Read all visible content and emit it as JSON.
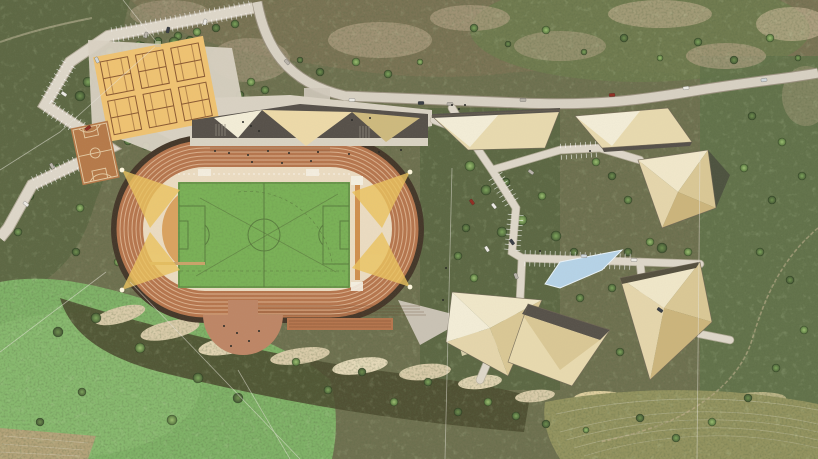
{
  "scene": {
    "title": "aerial masterplan rendering - hillside athletics park",
    "view": "top-down architectural site plan over aerial photo",
    "canvas": {
      "width": 818,
      "height": 459
    }
  },
  "palette": {
    "base": "#6f7150",
    "meadow": "#7fb267",
    "woodland": "#5c6743",
    "scrub": "#7b7354",
    "rock": "#d9cba9",
    "fieldOlive": "#93935f",
    "road": "#d7d0c2",
    "roadEdge": "#9a917f",
    "paving": "#d8d1c2",
    "stall": "#ffffff",
    "trackDark": "#45382a",
    "track": "#b5764e",
    "infield": "#eadbc1",
    "dzone": "#d79b55",
    "pitch": "#7ab157",
    "beam": "#eac35f",
    "tennis": "#eec272",
    "basketball": "#b57a4a",
    "roofCream": "#f2ecd6",
    "roofBeige": "#e7d9ae",
    "roofTan": "#cdb97e",
    "roofDark": "#57514a",
    "plaza": "#bd8666",
    "pool": "#b5d2e6",
    "person": "#2a2a26",
    "powerLine": "#e8e4da",
    "carColors": [
      "#eceae4",
      "#b9b4aa",
      "#8f2f23",
      "#3a3f46",
      "#cfd6da"
    ]
  },
  "features": {
    "stadium": {
      "name": "athletics stadium",
      "track_lanes": 8,
      "infield": "soccer pitch",
      "floodlight_beams": 4,
      "entrance_plaza": "semicircular south plaza"
    },
    "tennis_courts": {
      "count": 6,
      "rows": 2,
      "cols": 3
    },
    "basketball_court": {
      "count": 1
    },
    "grandstand": {
      "position": "north straight",
      "roof": "faceted triangles"
    },
    "buildings": {
      "count": 7,
      "style": "angular faceted stone roofs"
    },
    "pool": {
      "shape": "angular sliver"
    },
    "road": {
      "type": "mountain access road across north edge"
    },
    "parking": {
      "areas": [
        "northwest switchback lots",
        "cluster street parking"
      ]
    }
  },
  "parking": {
    "zigzag": [
      [
        253,
        8
      ],
      [
        108,
        36
      ],
      [
        70,
        62
      ],
      [
        45,
        105
      ],
      [
        110,
        148
      ],
      [
        32,
        185
      ],
      [
        8,
        228
      ]
    ],
    "tick_segments": [
      [
        253,
        8,
        108,
        36
      ],
      [
        70,
        62,
        45,
        105
      ],
      [
        45,
        105,
        110,
        148
      ],
      [
        110,
        148,
        32,
        185
      ],
      [
        494,
        174,
        514,
        206
      ],
      [
        522,
        258,
        636,
        262
      ],
      [
        516,
        212,
        512,
        252
      ],
      [
        644,
        300,
        700,
        334
      ],
      [
        558,
        152,
        598,
        149
      ]
    ]
  },
  "trees": [
    [
      235,
      24,
      4
    ],
    [
      216,
      28,
      4
    ],
    [
      197,
      32,
      4
    ],
    [
      178,
      36,
      4
    ],
    [
      158,
      41,
      4
    ],
    [
      139,
      45,
      4
    ],
    [
      121,
      49,
      4
    ],
    [
      104,
      55,
      5
    ],
    [
      96,
      68,
      5
    ],
    [
      88,
      82,
      5
    ],
    [
      80,
      96,
      5
    ],
    [
      110,
      52,
      5
    ],
    [
      126,
      49,
      5
    ],
    [
      142,
      46,
      4
    ],
    [
      158,
      44,
      4
    ],
    [
      174,
      42,
      5
    ],
    [
      190,
      40,
      4
    ],
    [
      220,
      118,
      5
    ],
    [
      206,
      132,
      5
    ],
    [
      190,
      143,
      5
    ],
    [
      146,
      146,
      4
    ],
    [
      128,
      141,
      4
    ],
    [
      63,
      118,
      4
    ],
    [
      98,
      152,
      4
    ],
    [
      58,
      168,
      4
    ],
    [
      30,
      196,
      4
    ],
    [
      80,
      208,
      4
    ],
    [
      18,
      232,
      4
    ],
    [
      240,
      95,
      4
    ],
    [
      251,
      82,
      4
    ],
    [
      265,
      90,
      4
    ],
    [
      320,
      72,
      4
    ],
    [
      356,
      62,
      4
    ],
    [
      388,
      74,
      4
    ],
    [
      300,
      60,
      3
    ],
    [
      420,
      62,
      3
    ],
    [
      474,
      28,
      4
    ],
    [
      508,
      44,
      3
    ],
    [
      546,
      30,
      4
    ],
    [
      584,
      52,
      3
    ],
    [
      624,
      38,
      4
    ],
    [
      660,
      58,
      3
    ],
    [
      698,
      42,
      4
    ],
    [
      734,
      60,
      4
    ],
    [
      770,
      38,
      4
    ],
    [
      798,
      58,
      3
    ],
    [
      752,
      116,
      4
    ],
    [
      782,
      142,
      4
    ],
    [
      802,
      176,
      4
    ],
    [
      772,
      200,
      4
    ],
    [
      744,
      168,
      4
    ],
    [
      760,
      252,
      4
    ],
    [
      790,
      280,
      4
    ],
    [
      804,
      330,
      4
    ],
    [
      776,
      368,
      4
    ],
    [
      748,
      398,
      4
    ],
    [
      712,
      422,
      4
    ],
    [
      676,
      438,
      4
    ],
    [
      640,
      418,
      4
    ],
    [
      470,
      166,
      5
    ],
    [
      486,
      190,
      5
    ],
    [
      506,
      182,
      4
    ],
    [
      522,
      220,
      5
    ],
    [
      502,
      232,
      5
    ],
    [
      466,
      228,
      4
    ],
    [
      542,
      196,
      4
    ],
    [
      556,
      236,
      5
    ],
    [
      574,
      252,
      4
    ],
    [
      592,
      266,
      5
    ],
    [
      612,
      288,
      4
    ],
    [
      628,
      252,
      4
    ],
    [
      650,
      242,
      4
    ],
    [
      580,
      298,
      4
    ],
    [
      552,
      322,
      4
    ],
    [
      528,
      342,
      4
    ],
    [
      506,
      318,
      4
    ],
    [
      488,
      300,
      4
    ],
    [
      474,
      278,
      4
    ],
    [
      458,
      256,
      4
    ],
    [
      612,
      176,
      4
    ],
    [
      596,
      162,
      4
    ],
    [
      628,
      200,
      4
    ],
    [
      662,
      248,
      5
    ],
    [
      688,
      252,
      4
    ],
    [
      700,
      300,
      4
    ],
    [
      676,
      332,
      4
    ],
    [
      650,
      356,
      4
    ],
    [
      620,
      352,
      4
    ],
    [
      592,
      348,
      4
    ],
    [
      566,
      358,
      4
    ],
    [
      96,
      318,
      5
    ],
    [
      58,
      332,
      5
    ],
    [
      140,
      348,
      5
    ],
    [
      198,
      378,
      5
    ],
    [
      238,
      398,
      5
    ],
    [
      172,
      420,
      5
    ],
    [
      82,
      392,
      4
    ],
    [
      40,
      422,
      4
    ],
    [
      296,
      362,
      4
    ],
    [
      328,
      390,
      4
    ],
    [
      362,
      372,
      4
    ],
    [
      394,
      402,
      4
    ],
    [
      428,
      382,
      4
    ],
    [
      458,
      412,
      4
    ],
    [
      488,
      402,
      4
    ],
    [
      516,
      416,
      4
    ],
    [
      546,
      424,
      4
    ],
    [
      586,
      430,
      3
    ],
    [
      248,
      228,
      4
    ],
    [
      180,
      250,
      4
    ],
    [
      150,
      232,
      4
    ],
    [
      216,
      232,
      3
    ],
    [
      76,
      252,
      4
    ],
    [
      118,
      262,
      4
    ]
  ],
  "cars": [
    [
      352,
      100,
      2,
      0
    ],
    [
      421,
      103,
      0,
      3
    ],
    [
      523,
      100,
      0,
      1
    ],
    [
      612,
      95,
      -4,
      2
    ],
    [
      686,
      88,
      -7,
      0
    ],
    [
      764,
      80,
      -8,
      4
    ],
    [
      287,
      62,
      48,
      1
    ],
    [
      205,
      22,
      -75,
      0
    ],
    [
      168,
      30,
      -75,
      3
    ],
    [
      146,
      35,
      -75,
      1
    ],
    [
      97,
      60,
      65,
      4
    ],
    [
      64,
      94,
      35,
      0
    ],
    [
      88,
      128,
      -35,
      2
    ],
    [
      52,
      166,
      60,
      1
    ],
    [
      26,
      204,
      40,
      0
    ],
    [
      494,
      206,
      52,
      0
    ],
    [
      512,
      242,
      55,
      3
    ],
    [
      531,
      172,
      38,
      1
    ],
    [
      584,
      256,
      4,
      4
    ],
    [
      634,
      260,
      2,
      0
    ],
    [
      472,
      202,
      55,
      2
    ],
    [
      487,
      249,
      58,
      0
    ],
    [
      516,
      276,
      68,
      1
    ],
    [
      660,
      310,
      35,
      3
    ],
    [
      450,
      104,
      0,
      1
    ]
  ],
  "people": [
    [
      215,
      151
    ],
    [
      229,
      153
    ],
    [
      248,
      155
    ],
    [
      268,
      151
    ],
    [
      289,
      153
    ],
    [
      318,
      152
    ],
    [
      349,
      154
    ],
    [
      379,
      152
    ],
    [
      401,
      150
    ],
    [
      252,
      162
    ],
    [
      282,
      163
    ],
    [
      311,
      161
    ],
    [
      224,
      326
    ],
    [
      237,
      333
    ],
    [
      249,
      341
    ],
    [
      231,
      346
    ],
    [
      259,
      331
    ],
    [
      243,
      122
    ],
    [
      251,
      126
    ],
    [
      259,
      131
    ],
    [
      452,
      105
    ],
    [
      459,
      109
    ],
    [
      465,
      105
    ],
    [
      590,
      151
    ],
    [
      540,
      251
    ],
    [
      446,
      268
    ],
    [
      443,
      300
    ],
    [
      352,
      120
    ],
    [
      370,
      118
    ]
  ]
}
